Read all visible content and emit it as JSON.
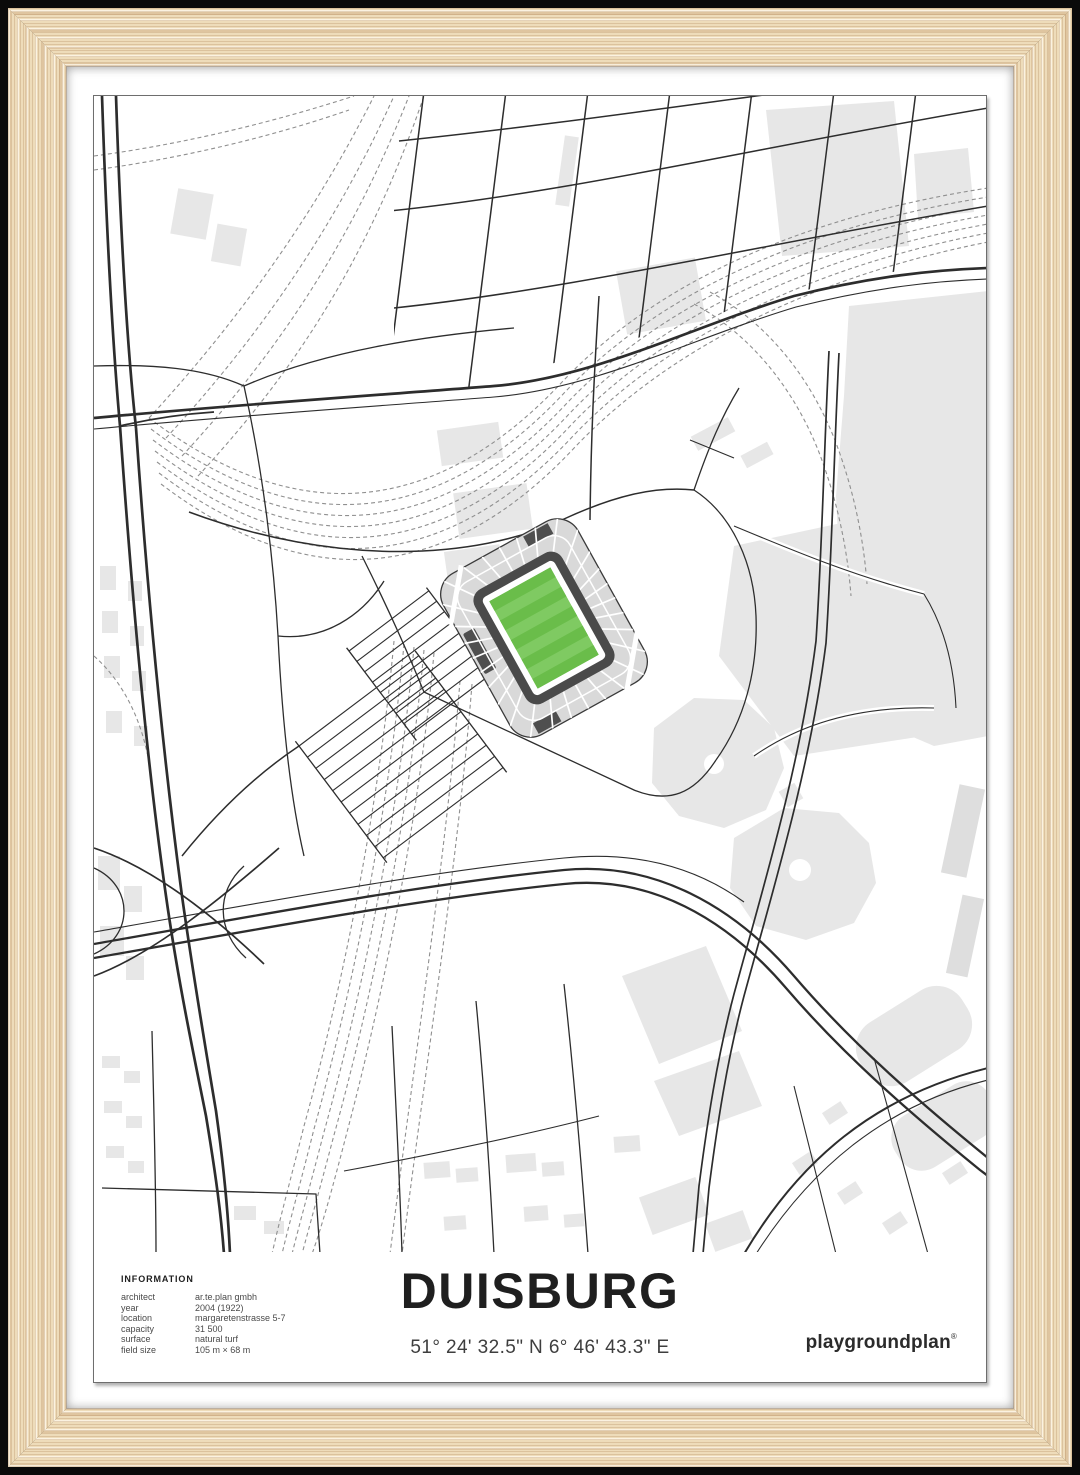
{
  "poster": {
    "title": "DUISBURG",
    "coordinates": "51° 24' 32.5\" N 6° 46' 43.3\" E",
    "brand": "playgroundplan",
    "brand_mark": "®",
    "information": {
      "heading": "INFORMATION",
      "rows": [
        {
          "label": "architect",
          "value": "ar.te.plan gmbh"
        },
        {
          "label": "year",
          "value": "2004 (1922)"
        },
        {
          "label": "location",
          "value": "margaretenstrasse 5-7"
        },
        {
          "label": "capacity",
          "value": "31 500"
        },
        {
          "label": "surface",
          "value": "natural turf"
        },
        {
          "label": "field size",
          "value": "105 m × 68 m"
        }
      ]
    }
  },
  "colors": {
    "road": "#2d2d2d",
    "building": "#e7e7e7",
    "stand": "#d9d9d9",
    "stand_dark": "#4a4a4a",
    "pitch_green": "#6abd4a",
    "pitch_green_light": "#7fca62",
    "wood": "#eedcba",
    "matte": "#ffffff"
  }
}
